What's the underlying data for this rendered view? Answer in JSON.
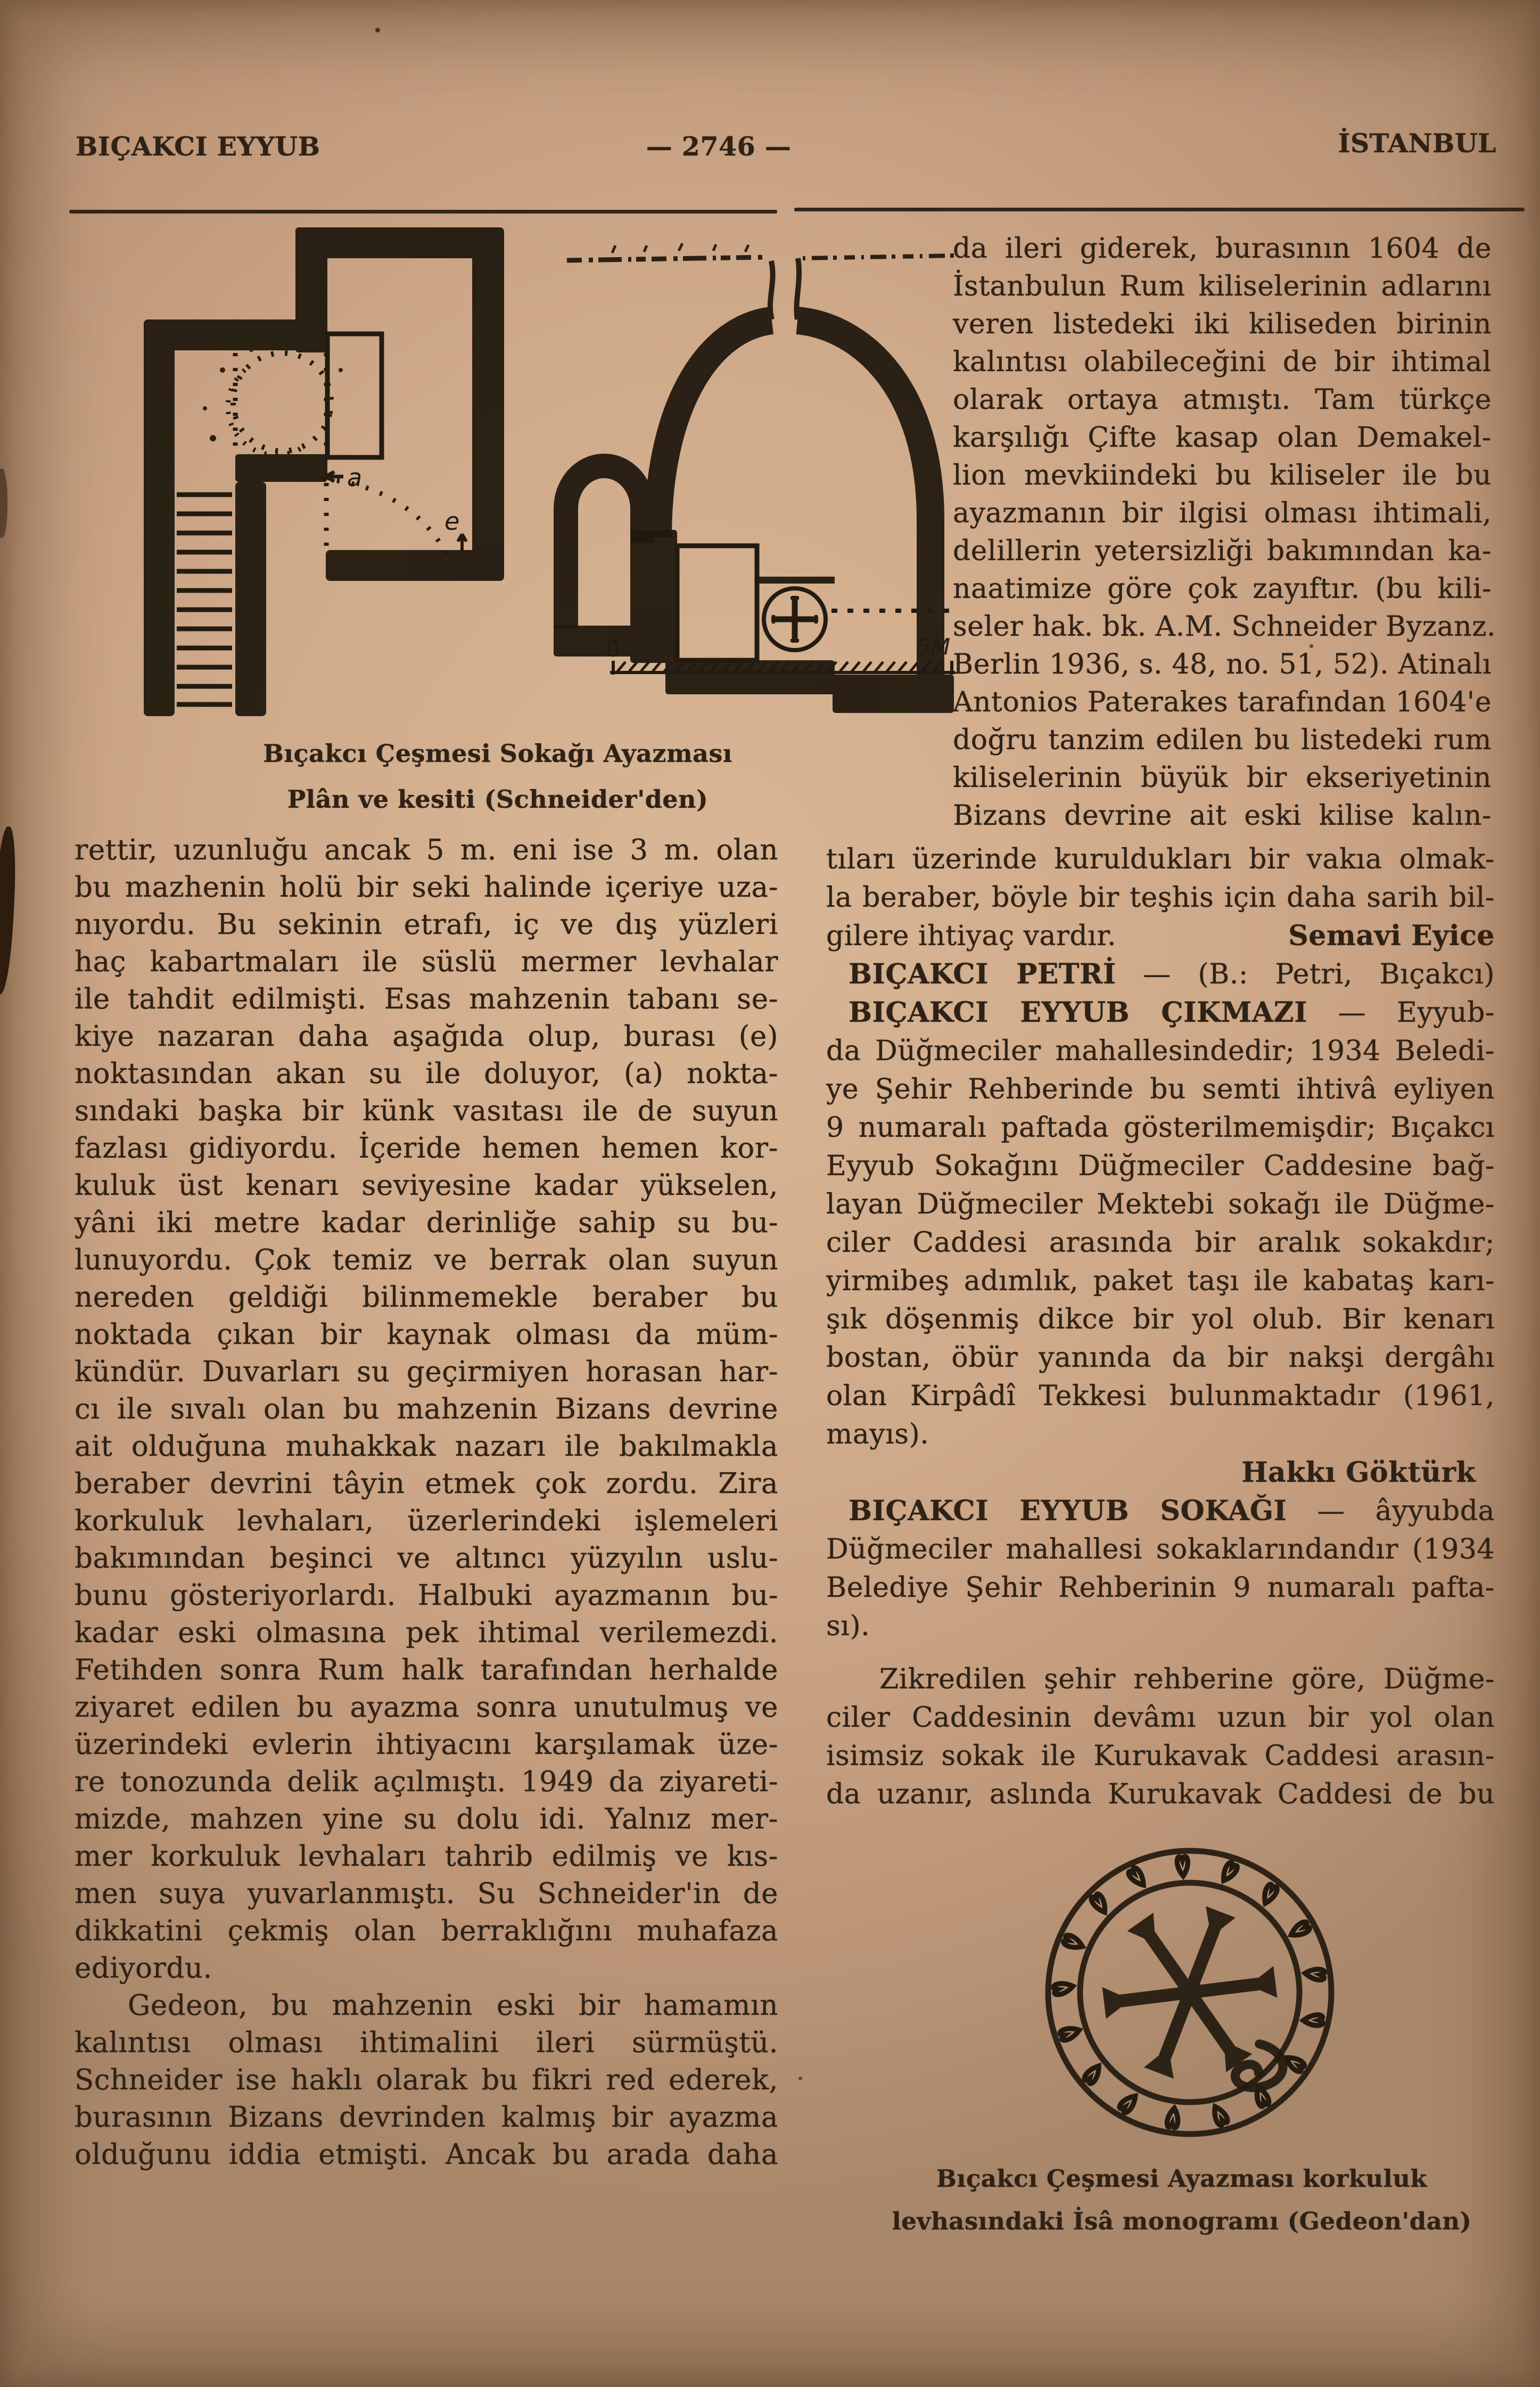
{
  "header": {
    "left": "BIÇAKCI EYYUB",
    "center": "— 2746 —",
    "right": "İSTANBUL"
  },
  "plan_figure": {
    "caption_line1": "Bıçakcı Çeşmesi Sokağı Ayazması",
    "caption_line2": "Plân ve kesiti (Schneider'den)",
    "labels": {
      "a": "a",
      "e": "e",
      "scale_zero": "0",
      "scale_end": "5M"
    }
  },
  "monogram_figure": {
    "caption_line1": "Bıçakcı Çeşmesi Ayazması korkuluk",
    "caption_line2": "levhasındaki İsâ monogramı (Gedeon'dan)"
  },
  "left_column": {
    "lines": [
      {
        "k": "j",
        "t": "rettir, uzunluğu ancak 5 m. eni ise 3 m. olan"
      },
      {
        "k": "j",
        "t": "bu mazhenin holü bir seki halinde içeriye uza-"
      },
      {
        "k": "j",
        "t": "nıyordu. Bu  sekinin etrafı, iç ve dış yüzleri"
      },
      {
        "k": "j",
        "t": "haç kabartmaları ile süslü  mermer levhalar"
      },
      {
        "k": "j",
        "t": "ile tahdit edilmişti. Esas mahzenin tabanı se-"
      },
      {
        "k": "j",
        "t": "kiye nazaran daha  aşağıda olup, burası (e)"
      },
      {
        "k": "j",
        "t": "noktasından  akan su ile doluyor, (a) nokta-"
      },
      {
        "k": "j",
        "t": "sındaki başka bir künk vasıtası ile de suyun"
      },
      {
        "k": "j",
        "t": "fazlası gidiyordu. İçeride hemen hemen kor-"
      },
      {
        "k": "j",
        "t": "kuluk üst kenarı seviyesine kadar  yükselen,"
      },
      {
        "k": "j",
        "t": "yâni iki metre kadar derinliğe sahip su bu-"
      },
      {
        "k": "j",
        "t": "lunuyordu. Çok temiz ve berrak olan suyun"
      },
      {
        "k": "j",
        "t": "nereden geldiği  bilinmemekle  beraber bu"
      },
      {
        "k": "j",
        "t": "noktada  çıkan bir kaynak olması da müm-"
      },
      {
        "k": "j",
        "t": "kündür. Duvarları su geçirmiyen horasan har-"
      },
      {
        "k": "j",
        "t": "cı ile sıvalı olan bu mahzenin Bizans devrine"
      },
      {
        "k": "j",
        "t": "ait olduğuna muhakkak nazarı ile bakılmakla"
      },
      {
        "k": "j",
        "t": "beraber devrini tâyin etmek çok zordu. Zira"
      },
      {
        "k": "j",
        "t": "korkuluk levhaları,  üzerlerindeki işlemeleri"
      },
      {
        "k": "j",
        "t": "bakımından  beşinci ve altıncı yüzyılın uslu-"
      },
      {
        "k": "j",
        "t": "bunu gösteriyorlardı. Halbuki ayazmanın bu-"
      },
      {
        "k": "j",
        "t": "kadar eski olmasına pek ihtimal verilemezdi."
      },
      {
        "k": "j",
        "t": "Fetihden sonra Rum halk tarafından herhalde"
      },
      {
        "k": "j",
        "t": "ziyaret edilen bu ayazma sonra unutulmuş ve"
      },
      {
        "k": "j",
        "t": "üzerindeki evlerin ihtiyacını karşılamak üze-"
      },
      {
        "k": "j",
        "t": "re tonozunda delik açılmıştı. 1949 da ziyareti-"
      },
      {
        "k": "j",
        "t": "mizde, mahzen yine su dolu idi. Yalnız mer-"
      },
      {
        "k": "j",
        "t": "mer korkuluk levhaları tahrib edilmiş ve kıs-"
      },
      {
        "k": "j",
        "t": "men suya yuvarlanmıştı. Su Schneider'in de"
      },
      {
        "k": "j",
        "t": "dikkatini çekmiş olan  berraklığını muhafaza"
      },
      {
        "k": "e",
        "t": "ediyordu."
      },
      {
        "k": "i",
        "t": "Gedeon, bu  mahzenin eski bir hamamın"
      },
      {
        "k": "j",
        "t": "kalıntısı  olması   ihtimalini ileri   sürmüştü."
      },
      {
        "k": "j",
        "t": "Schneider ise haklı olarak bu fikri red ederek,"
      },
      {
        "k": "j",
        "t": "burasının Bizans devrinden kalmış bir ayazma"
      },
      {
        "k": "j",
        "t": "olduğunu  iddia etmişti. Ancak bu arada daha"
      }
    ]
  },
  "right_column": {
    "beside_figure_lines": [
      {
        "k": "j",
        "t": "da ileri giderek, burasının  1604  de"
      },
      {
        "k": "j",
        "t": "İstanbulun Rum kiliselerinin adlarını"
      },
      {
        "k": "j",
        "t": "veren  listedeki iki kiliseden birinin"
      },
      {
        "k": "j",
        "t": "kalıntısı olabileceğini de bir ihtimal"
      },
      {
        "k": "j",
        "t": "olarak  ortaya atmıştı. Tam  türkçe"
      },
      {
        "k": "j",
        "t": "karşılığı Çifte kasap olan  Demakel-"
      },
      {
        "k": "j",
        "t": "lion mevkiindeki bu  kiliseler ile bu"
      },
      {
        "k": "j",
        "t": "ayazmanın bir ilgisi olması  ihtimali,"
      },
      {
        "k": "j",
        "t": "delillerin yetersizliği bakımından ka-"
      },
      {
        "k": "j",
        "t": "naatimize göre çok zayıftır. (bu kili-"
      },
      {
        "k": "j",
        "t": "seler hak. bk. A.M. Schneider Byzanz."
      },
      {
        "k": "j",
        "t": "Berlin 1936, s. 48, no. 51, 52). Atinalı"
      },
      {
        "k": "j",
        "t": "Antonios Paterakes tarafından 1604'e"
      },
      {
        "k": "j",
        "t": "doğru tanzim edilen bu listedeki rum"
      },
      {
        "k": "j",
        "t": "kiliselerinin büyük bir  ekseriyetinin"
      },
      {
        "k": "j",
        "t": "Bizans devrine ait eski  kilise kalın-"
      }
    ],
    "flow_lines": [
      {
        "k": "j",
        "t": "tıları üzerinde kuruldukları bir vakıa olmak-"
      },
      {
        "k": "j",
        "t": "la beraber, böyle bir teşhis için daha sarih bil-"
      },
      {
        "k": "sig",
        "t": "gilere ihtiyaç vardır.",
        "a": "Semavi Eyice"
      },
      {
        "k": "entry",
        "t": "BIÇAKCI PETRİ",
        "r": "— (B.: Petri, Bıçakcı)"
      },
      {
        "k": "entry",
        "t": "BIÇAKCI EYYUB ÇIKMAZI",
        "r": "— Eyyub-"
      },
      {
        "k": "j",
        "t": "da Düğmeciler mahallesindedir; 1934 Beledi-"
      },
      {
        "k": "j",
        "t": "ye Şehir Rehberinde bu semti ihtivâ eyliyen"
      },
      {
        "k": "j",
        "t": "9 numaralı paftada gösterilmemişdir; Bıçakcı"
      },
      {
        "k": "j",
        "t": "Eyyub Sokağını Düğmeciler  Caddesine bağ-"
      },
      {
        "k": "j",
        "t": "layan Düğmeciler Mektebi sokağı ile Düğme-"
      },
      {
        "k": "j",
        "t": "ciler Caddesi  arasında bir aralık sokakdır;"
      },
      {
        "k": "j",
        "t": "yirmibeş adımlık, paket taşı ile kabataş karı-"
      },
      {
        "k": "j",
        "t": "şık döşenmiş  dikce bir yol olub. Bir kenarı"
      },
      {
        "k": "j",
        "t": "bostan, öbür  yanında da bir nakşi dergâhı"
      },
      {
        "k": "j",
        "t": "olan Kirpâdî Tekkesi  bulunmaktadır (1961,"
      },
      {
        "k": "e",
        "t": "mayıs)."
      },
      {
        "k": "author",
        "t": "Hakkı Göktürk"
      },
      {
        "k": "entry",
        "t": "BIÇAKCI EYYUB SOKAĞI",
        "r": "— âyyubda"
      },
      {
        "k": "j",
        "t": "Düğmeciler mahallesi sokaklarındandır (1934"
      },
      {
        "k": "j",
        "t": "Belediye Şehir Rehberinin 9 numaralı pafta-"
      },
      {
        "k": "e",
        "t": "sı)."
      },
      {
        "k": "i",
        "t": "Zikredilen şehir rehberine göre, Düğme-",
        "m": 28
      },
      {
        "k": "j",
        "t": "ciler Caddesinin  devâmı uzun bir yol olan"
      },
      {
        "k": "j",
        "t": "isimsiz sokak ile Kurukavak Caddesi arasın-"
      },
      {
        "k": "j",
        "t": "da uzanır, aslında Kurukavak Caddesi de bu"
      }
    ]
  }
}
